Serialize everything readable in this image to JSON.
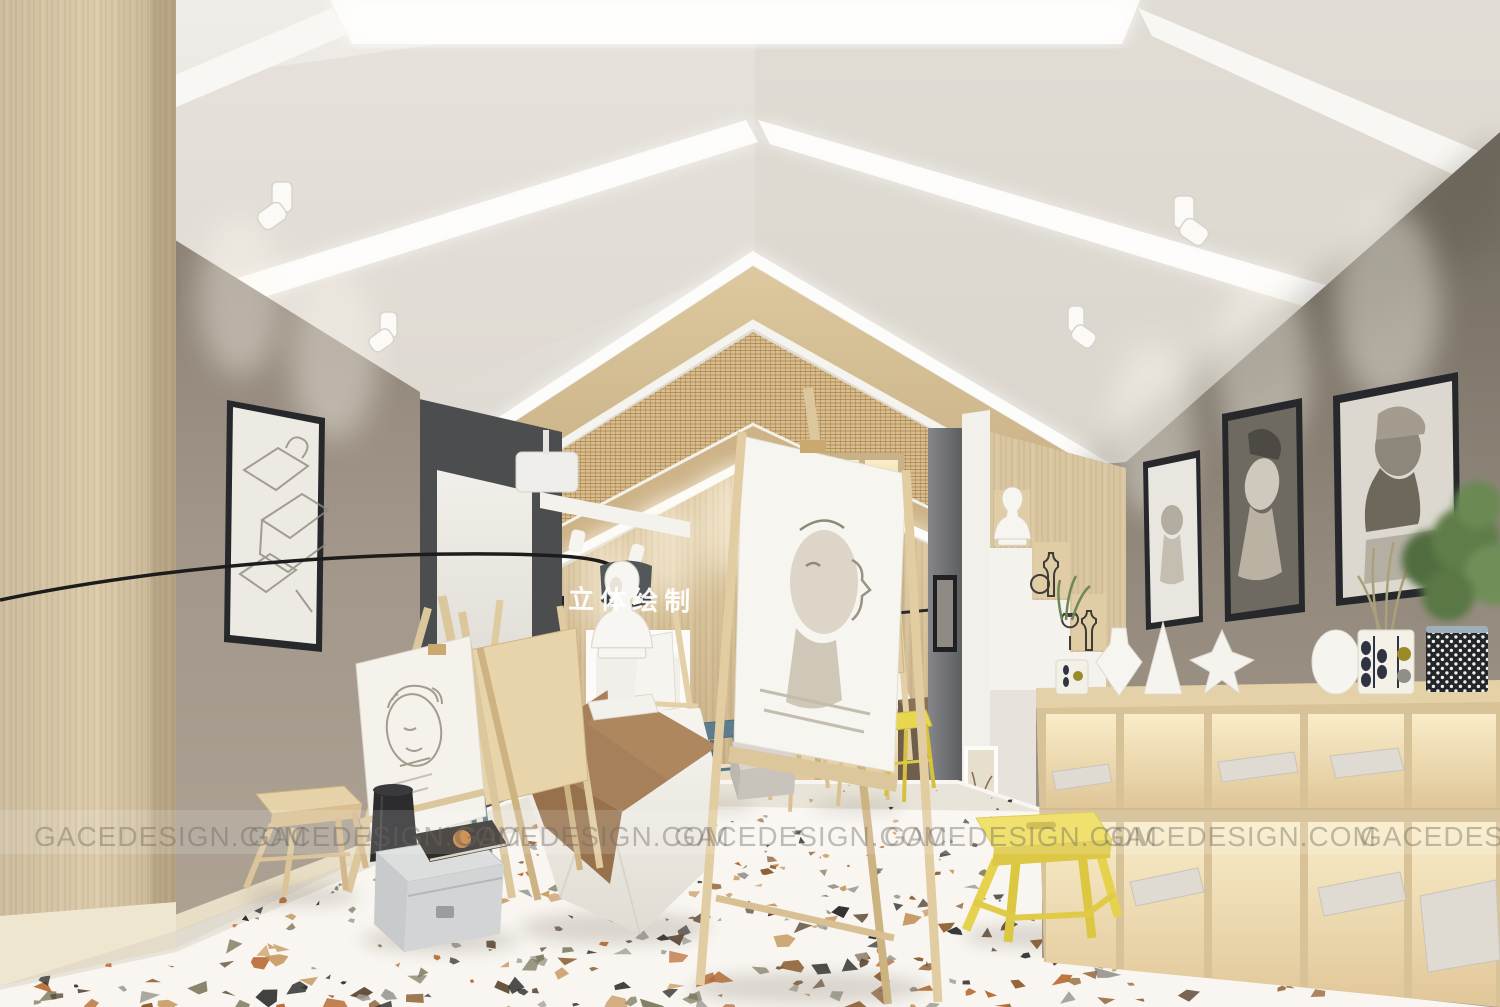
{
  "scene": {
    "kind": "3D interior rendering",
    "setting": "art sketching studio classroom with gabled ceiling, wood feature wall and terrazzo floor",
    "wall_sign": {
      "text": "立体绘制",
      "color": "#ffffff"
    },
    "watermark": {
      "text": "GACEDESIGN.COM",
      "count": 7
    },
    "palette": {
      "ceiling": "#e9e5de",
      "wood_wall": "#d8c5a0",
      "wood_column": "#d2c2a3",
      "left_wall": "#a1968a",
      "right_wall": "#8f867a",
      "dark_panel": "#4b4d4f",
      "floor": "#f9f6f1",
      "stool_yellow": "#ecd94e",
      "stool_blue": "#5d7c8e",
      "cloth_brown": "#a5805a",
      "terrazzo_chips": [
        "#2b2b2b",
        "#8a5a2b",
        "#c89a63",
        "#7c7a5e",
        "#b86a32",
        "#9c9c94",
        "#5a4632"
      ]
    },
    "objects": [
      "gabled ceiling with recessed light strips",
      "wood grille canopy",
      "projection screen on dark panel",
      "wall niche with plaster bust",
      "lit display bookshelf",
      "white partition with stepped display and busts",
      "framed charcoal portrait drawings",
      "wooden easels with sketches",
      "still-life table with brown drape and plaster bust",
      "yellow and blue wooden stools",
      "metal storage box with sketchbook",
      "lit cubby shelf with vases and plants",
      "terrazzo floor"
    ]
  }
}
